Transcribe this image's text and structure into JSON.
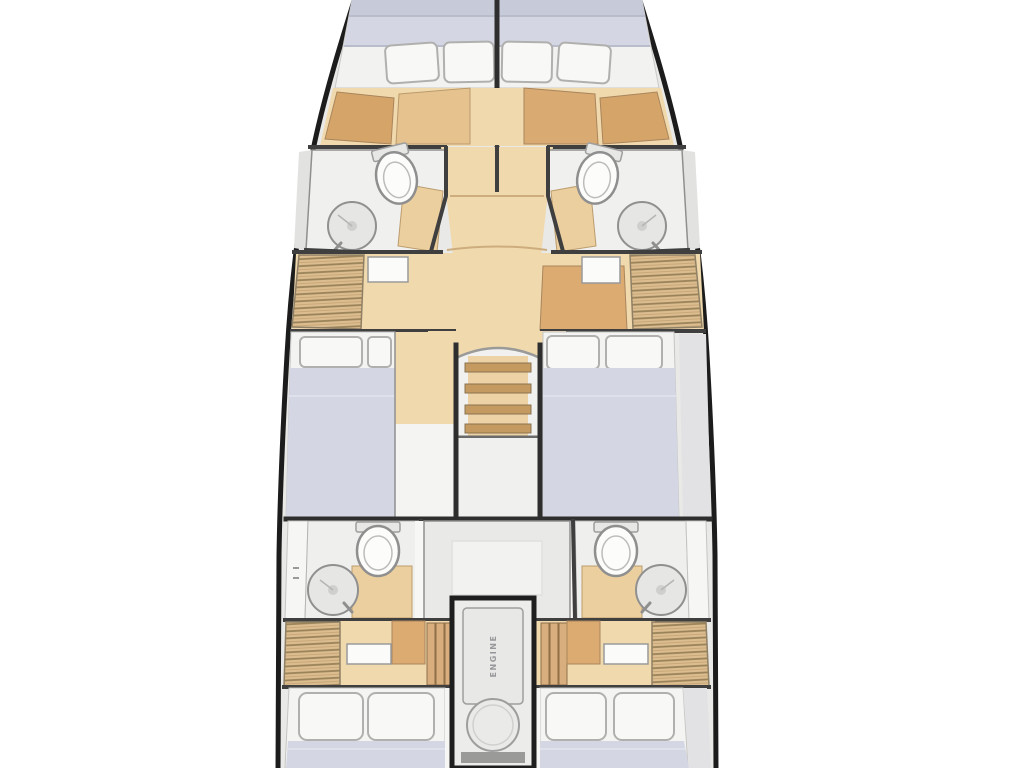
{
  "engine_room": {
    "label": "ENGINE"
  },
  "palette": {
    "hull_outline": "#1c1c1c",
    "deck": "#e9e9e7",
    "floor_white": "#f0f0ee",
    "wood_light": "#f1d9ae",
    "wood_medium": "#e6c28e",
    "wood_dark": "#d5a469",
    "rattan": "#dcbd90",
    "mattress": "#d4d7e3",
    "mattress_dark": "#c6cad9",
    "pillow": "#f8f8f6",
    "wall": "#3f3f3f",
    "fixture_outline": "#8f8f8f",
    "panel_grey": "#e9e9e7"
  }
}
